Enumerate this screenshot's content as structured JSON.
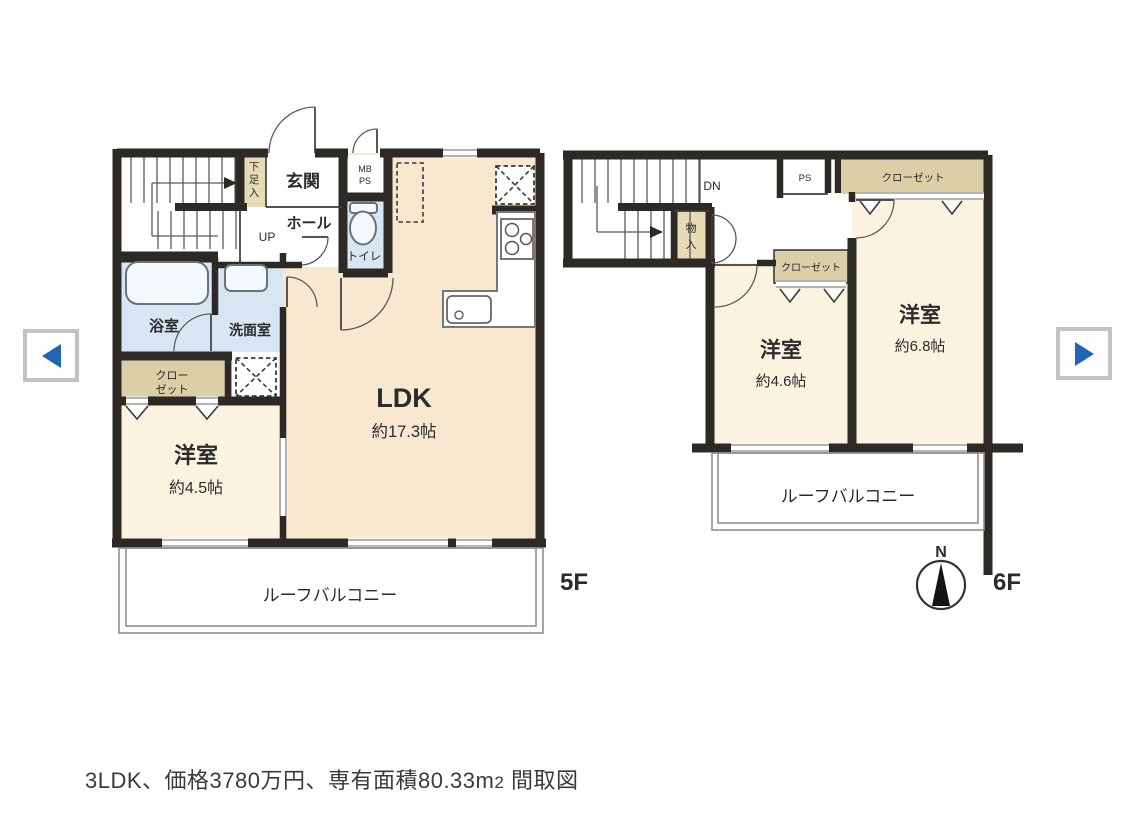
{
  "nav": {
    "prev_icon": "left-triangle",
    "next_icon": "right-triangle",
    "accent_color": "#2166b4"
  },
  "caption": {
    "pre": "3LDK、価格3780万円、専有面積80.33m",
    "area_digit": "2",
    "post": " 間取図"
  },
  "palette": {
    "wall": "#2d2a26",
    "ldk_fill": "#f8e8cf",
    "bedroom_fill": "#fbf3e0",
    "water_fill": "#d8e6f3",
    "closet_fill": "#dbcfa8",
    "window_line": "#9a9a9a"
  },
  "floor5": {
    "label": "5F",
    "entrance": "玄関",
    "shoe_cupboard": [
      "下",
      "足",
      "入"
    ],
    "meter_box": "MB",
    "pipe_shaft": "PS",
    "hall": "ホール",
    "stairs_up": "UP",
    "toilet": "トイレ",
    "bath": "浴室",
    "washroom": "洗面室",
    "closet_lines": [
      "クロー",
      "ゼット"
    ],
    "bedroom": {
      "name": "洋室",
      "size": "約4.5帖"
    },
    "ldk": {
      "name": "LDK",
      "size": "約17.3帖"
    },
    "balcony": "ルーフバルコニー"
  },
  "floor6": {
    "label": "6F",
    "stairs_down": "DN",
    "storage": [
      "物",
      "入"
    ],
    "pipe_shaft": "PS",
    "closet_top": "クローゼット",
    "closet_mid": "クローゼット",
    "bedroom_small": {
      "name": "洋室",
      "size": "約4.6帖"
    },
    "bedroom_large": {
      "name": "洋室",
      "size": "約6.8帖"
    },
    "balcony": "ルーフバルコニー",
    "compass_north": "N"
  }
}
